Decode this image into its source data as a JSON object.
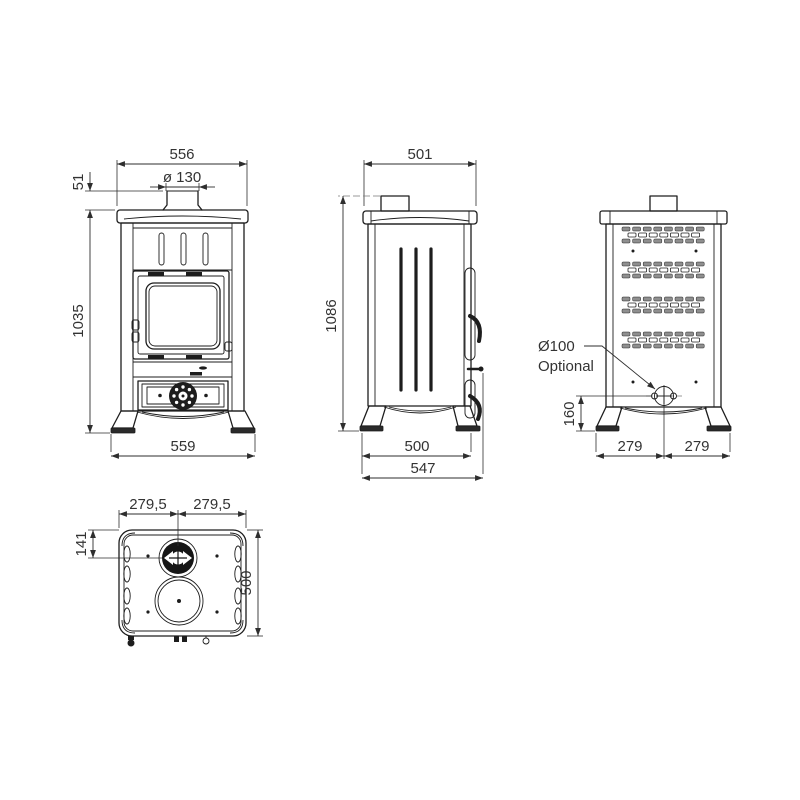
{
  "canvas": {
    "background": "#ffffff",
    "line_color": "#1d1d1d",
    "dimension_color": "#2e2e2e"
  },
  "views": {
    "front": {
      "dims": {
        "top_width": "556",
        "flue_diameter": "ø 130",
        "flue_stub_height": "51",
        "body_height": "1035",
        "base_width": "559"
      }
    },
    "side": {
      "dims": {
        "top_depth": "501",
        "total_height": "1086",
        "foot_span": "500",
        "overall_depth": "547"
      }
    },
    "back": {
      "dims": {
        "flue_outlet_diameter": "Ø100",
        "flue_outlet_note": "Optional",
        "outlet_center_height": "160",
        "half_width_left": "279",
        "half_width_right": "279"
      }
    },
    "top": {
      "dims": {
        "half_width_left": "279,5",
        "half_width_right": "279,5",
        "flue_center_offset": "141",
        "depth": "500"
      }
    }
  }
}
